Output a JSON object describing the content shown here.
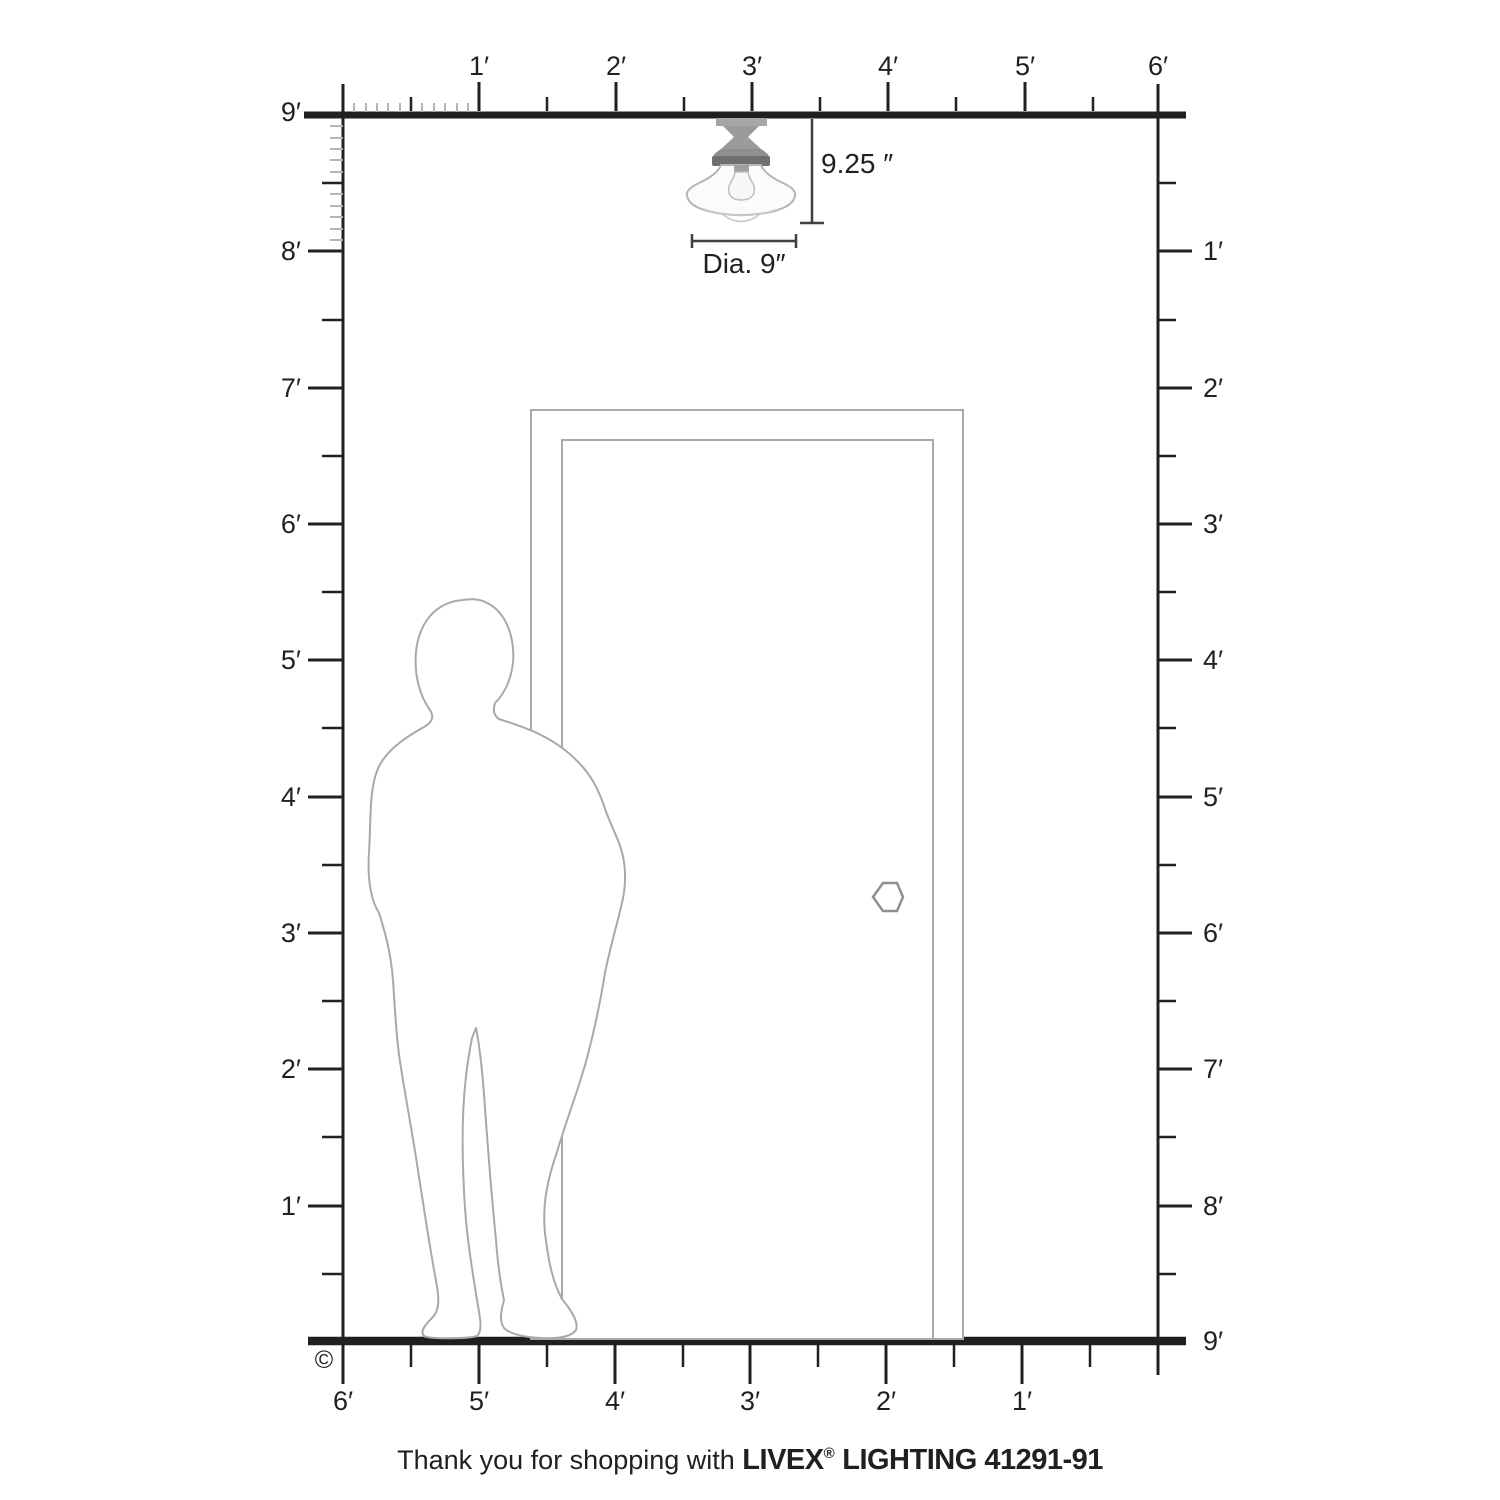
{
  "rulers": {
    "top": {
      "labels": [
        "1′",
        "2′",
        "3′",
        "4′",
        "5′",
        "6′"
      ]
    },
    "left": {
      "labels": [
        "9′",
        "8′",
        "7′",
        "6′",
        "5′",
        "4′",
        "3′",
        "2′",
        "1′"
      ]
    },
    "right": {
      "labels": [
        "1′",
        "2′",
        "3′",
        "4′",
        "5′",
        "6′",
        "7′",
        "8′",
        "9′"
      ]
    },
    "bottom": {
      "labels": [
        "6′",
        "5′",
        "4′",
        "3′",
        "2′",
        "1′"
      ]
    }
  },
  "fixture": {
    "name": "semi-flush schoolhouse ceiling light",
    "height_label": "9.25 ″",
    "diameter_label": "Dia. 9″"
  },
  "copyright_symbol": "©",
  "caption": {
    "prefix": "Thank you for shopping with ",
    "brand": "LIVEX",
    "registered": "®",
    "suffix": " LIGHTING 41291-91"
  },
  "colors": {
    "ink": "#231f20",
    "light_tick": "#b5b5b5",
    "outline_gray": "#a9a9a9",
    "dim_line": "#3f3f3f"
  }
}
